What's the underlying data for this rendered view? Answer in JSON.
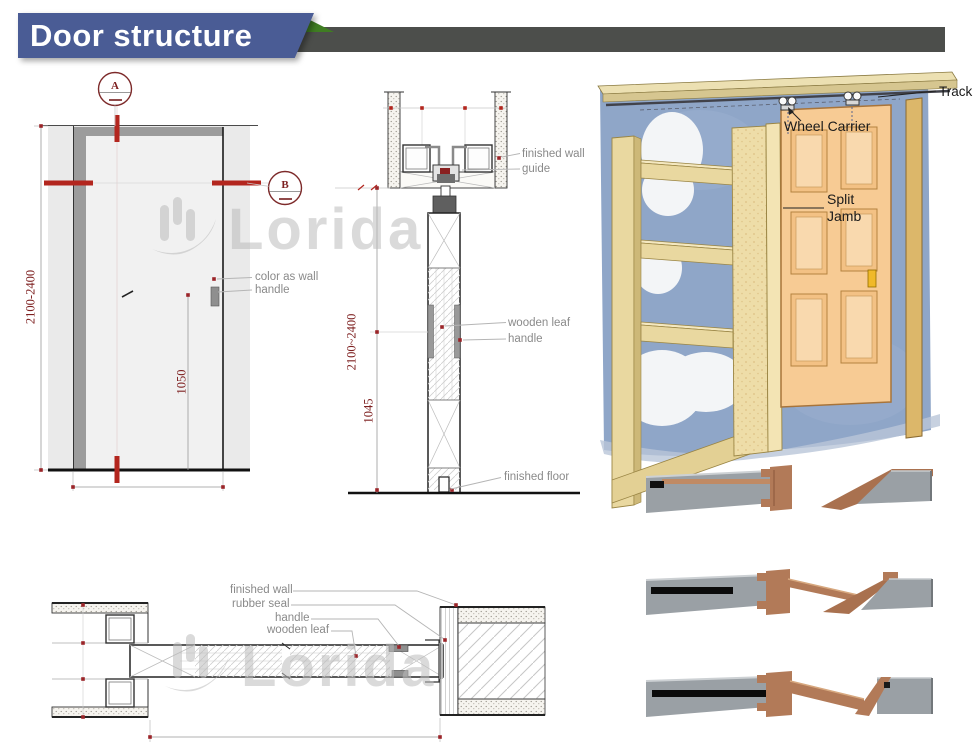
{
  "header": {
    "title": "Door structure"
  },
  "watermark": {
    "text": "Lorida"
  },
  "elevation": {
    "marker_a": "A",
    "marker_b": "B",
    "dim_height": "2100-2400",
    "dim_handle_height": "1050",
    "label_color_as_wall": "color as wall",
    "label_handle": "handle"
  },
  "section": {
    "label_finished_wall": "finished wall",
    "label_guide": "guide",
    "label_wooden_leaf": "wooden leaf",
    "label_handle": "handle",
    "label_finished_floor": "finished floor",
    "dim_height": "2100~2400",
    "dim_handle_height": "1045"
  },
  "illustration": {
    "label_track": "Track",
    "label_wheel_carrier": "Wheel Carrier",
    "label_split_jamb": "Split Jamb"
  },
  "plan": {
    "label_finished_wall": "finished wall",
    "label_rubber_seal": "rubber seal",
    "label_handle": "handle",
    "label_wooden_leaf": "wooden leaf"
  },
  "palette": {
    "header-blue": "#4a5c95",
    "header-bar-gray": "#4c4e4b",
    "header-green": "#3f7d22",
    "dim-maroon": "#7d1f1f",
    "mark-red": "#b3261e",
    "label-gray": "#8a8a8a",
    "wall-fill-gray": "#eaeaea",
    "frame-gray": "#9c9c9c",
    "wall-blue": "#8fa6c8",
    "lumber-tan": "#e9d8a0",
    "door-wood": "#f7cb94",
    "latch-gold": "#f0b929",
    "profile-gray": "#9aa0a5",
    "profile-copper": "#b27a58",
    "rubber-black": "#0b0b0b",
    "watermark-gray": "#bcbcbc"
  }
}
